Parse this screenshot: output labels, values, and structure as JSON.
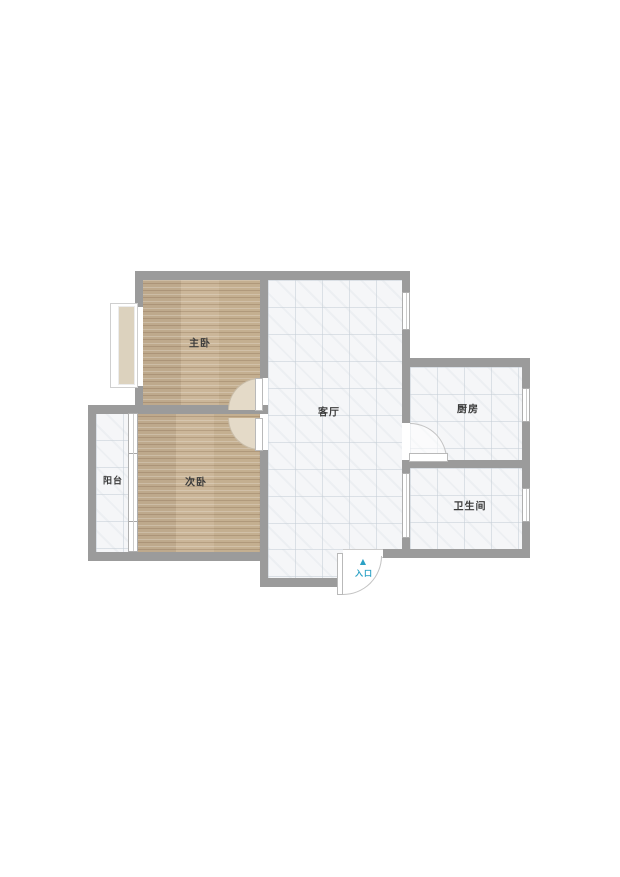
{
  "floorplan": {
    "rooms": [
      {
        "name": "master-bedroom",
        "label": "主卧",
        "floor": "wood"
      },
      {
        "name": "second-bedroom",
        "label": "次卧",
        "floor": "wood"
      },
      {
        "name": "balcony",
        "label": "阳台",
        "floor": "tile"
      },
      {
        "name": "living-room",
        "label": "客厅",
        "floor": "tile"
      },
      {
        "name": "kitchen",
        "label": "厨房",
        "floor": "tile"
      },
      {
        "name": "bathroom",
        "label": "卫生间",
        "floor": "tile"
      }
    ],
    "entrance": {
      "label": "入口",
      "arrow": "▲"
    },
    "colors": {
      "wall": "#9b9b9b",
      "wood_floor": "#c8b293",
      "tile_floor": "#f5f6f8",
      "window_fill": "#dcd2be",
      "entrance_accent": "#2ba1c5",
      "label_text": "#3b3b3b",
      "background": "#ffffff"
    }
  }
}
